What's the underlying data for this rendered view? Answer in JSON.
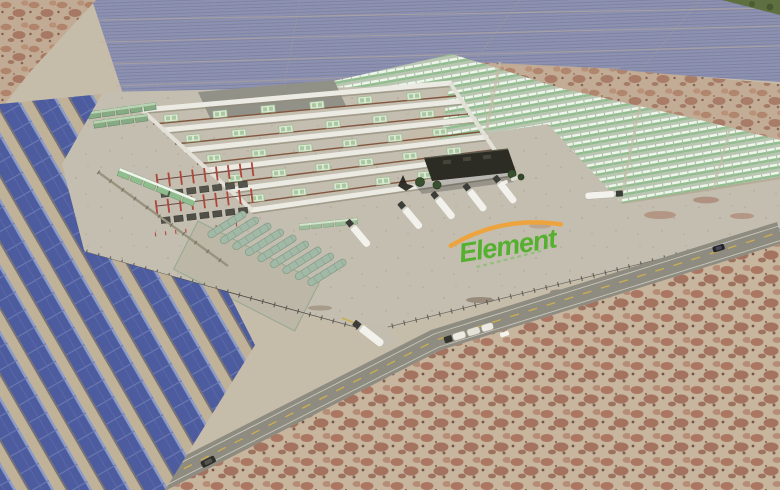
{
  "title": "Aerial 3D rendering of Element solar-powered hydrogen and storage facility in desert",
  "logo": {
    "text": "Element",
    "text_color": "#56b02f",
    "arc_color": "#eda43e"
  },
  "scene": {
    "features": [
      "far solar photovoltaic field on horizon",
      "foreground tilted solar array rows",
      "green container yard (modular units)",
      "walled electrolyzer compound with equipment corridors",
      "red-framed electrical substation with transformers",
      "row of horizontal cylindrical storage tanks",
      "admin building with trees",
      "parked white tanker trucks",
      "ground-painted Element logo",
      "diagonal highway with vehicles",
      "security fence with gate",
      "mottled red desert terrain"
    ],
    "counts": {
      "compound_wall_rows": 6,
      "equipment_corridors": 5,
      "storage_tanks": 9,
      "parked_tanker_trucks": 5,
      "trucks_on_road": 3,
      "cars": 2
    },
    "colors": {
      "desert_sand": "#c6bcaa",
      "desert_red": "#a5705c",
      "solar_far": "#8f93b3",
      "solar_panel_near": "#4d5c9e",
      "container_green": "#8fbd8d",
      "container_roof": "#eef5ea",
      "wall_white": "#ecebe3",
      "pad_concrete": "#c4beb0",
      "loading_pad_gray": "#929188",
      "pipe_rust": "#7a4a32",
      "substation_red": "#b0453a",
      "tank_green": "#a3b9a8",
      "building_dark": "#2c2b24",
      "tree_green": "#3a5130",
      "road_asphalt": "#8e8b81",
      "road_line_yellow": "#cfae4e",
      "truck_white": "#f2f1ec"
    }
  }
}
